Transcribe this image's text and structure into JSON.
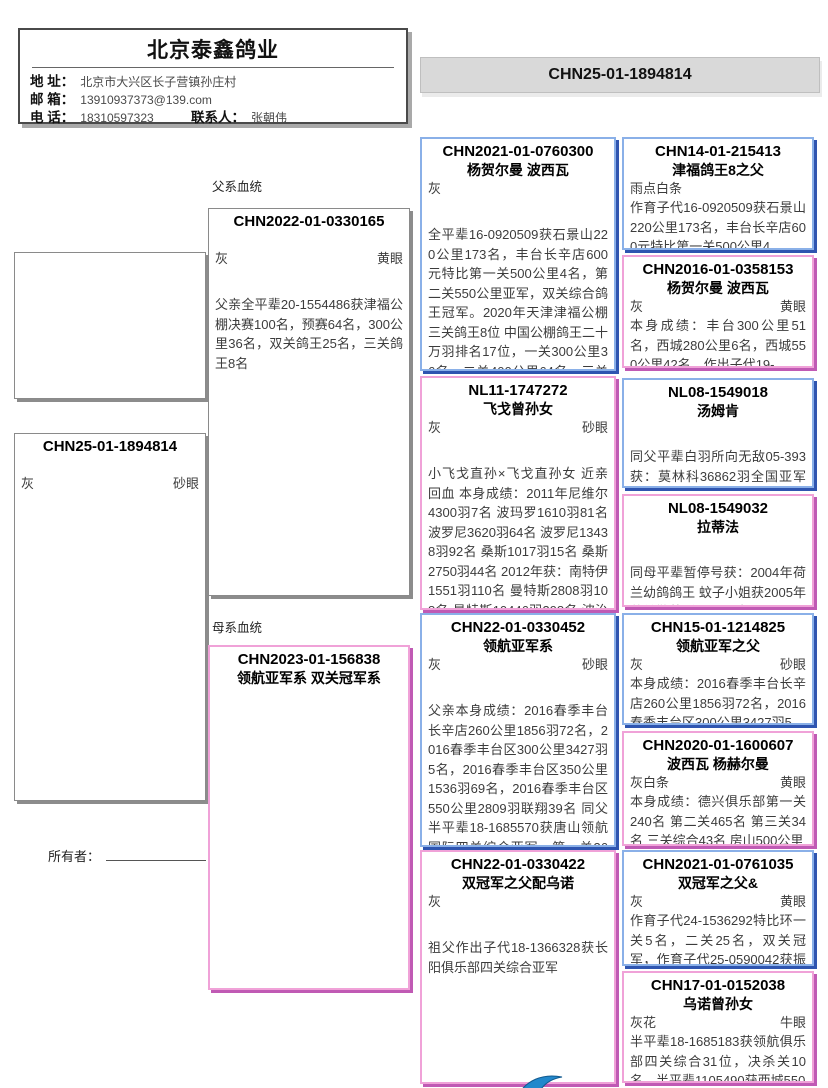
{
  "colors": {
    "cock-border": "#8ab0e8",
    "cock-shadow": "#2f55b0",
    "hen-border": "#f0a2d8",
    "hen-shadow": "#c05ab4",
    "bar-bg": "#d9d9d9",
    "logo-blue": "#2288cc"
  },
  "loft": {
    "name": "北京泰鑫鸽业",
    "address_label": "地 址：",
    "address": "北京市大兴区长子营镇孙庄村",
    "email_label": "邮 箱：",
    "email": "13910937373@139.com",
    "phone_label": "电 话：",
    "phone": "18310597323",
    "contact_label": "联系人：",
    "contact": "张朝伟"
  },
  "header": {
    "ring": "CHN25-01-1894814"
  },
  "labels": {
    "paternal": "父系血统",
    "maternal": "母系血统",
    "owner": "所有者："
  },
  "subject": {
    "ring": "CHN25-01-1894814",
    "color": "灰",
    "eye": "砂眼"
  },
  "gen2": [
    {
      "ring": "CHN2022-01-0330165",
      "name": "",
      "color": "灰",
      "eye": "黄眼",
      "desc": "父亲全平辈20-1554486获津福公棚决赛100名，预赛64名，300公里36名，双关鸽王25名，三关鸽王8名"
    },
    {
      "ring": "CHN2023-01-156838",
      "name": "领航亚军系 双关冠军系",
      "color": "",
      "eye": "",
      "desc": ""
    }
  ],
  "gen3": [
    {
      "ring": "CHN2021-01-0760300",
      "name": "杨贺尔曼 波西瓦",
      "color": "灰",
      "eye": "",
      "desc": "全平辈16-0920509获石景山220公里173名，丰台长辛店600元特比第一关500公里4名，第二关550公里亚军，双关综合鸽王冠军。2020年天津津福公棚三关鸽王8位 中国公棚鸽王二十万羽排名17位，一关300公里36名，二关400公里64名，三关500公"
    },
    {
      "ring": "NL11-1747272",
      "name": "飞戈曾孙女",
      "color": "灰",
      "eye": "砂眼",
      "desc": "小飞戈直孙×飞戈直孙女 近亲回血 本身成绩：2011年尼维尔4300羽7名 波玛罗1610羽81名 波罗尼3620羽64名 波罗尼13438羽92名 桑斯1017羽15名 桑斯2750羽44名 2012年获：南特伊1551羽110名 曼特斯2808羽108名 曼特斯10446羽398名 波治2078羽473名 查特"
    },
    {
      "ring": "CHN22-01-0330452",
      "name": "领航亚军系",
      "color": "灰",
      "eye": "砂眼",
      "desc": "父亲本身成绩：2016春季丰台长辛店260公里1856羽72名，2016春季丰台区300公里3427羽5名，2016春季丰台区350公里1536羽69名，2016春季丰台区550公里2809羽联翔39名 同父半平辈18-1685570获唐山领航国际四关综合亚军，第一关36名、第二关18名、第三关32"
    },
    {
      "ring": "CHN22-01-0330422",
      "name": "双冠军之父配乌诺",
      "color": "灰",
      "eye": "",
      "desc": "祖父作出子代18-1366328获长阳俱乐部四关综合亚军"
    }
  ],
  "gen4": [
    {
      "ring": "CHN14-01-215413",
      "name": "津福鸽王8之父",
      "color": "雨点白条",
      "eye": "",
      "desc": "作育子代16-0920509获石景山220公里173名，丰台长辛店600元特比第一关500公里4"
    },
    {
      "ring": "CHN2016-01-0358153",
      "name": "杨贺尔曼 波西瓦",
      "color": "灰",
      "eye": "黄眼",
      "desc": "本身成绩：丰台300公里51名，西城280公里6名，西城550公里42名，作出子代19-"
    },
    {
      "ring": "NL08-1549018",
      "name": "汤姆肯",
      "color": "",
      "eye": "",
      "desc": "同父平辈白羽所向无敌05-393获：莫林科36862羽全国亚军 香提利22571羽7名 平辈娜拉"
    },
    {
      "ring": "NL08-1549032",
      "name": "拉蒂法",
      "color": "",
      "eye": "",
      "desc": "同母平辈暂停号获：2004年荷兰幼鸽鸽王 蚊子小姐获2005年荷兰勒芒斯12万羽全国亚军"
    },
    {
      "ring": "CHN15-01-1214825",
      "name": "领航亚军之父",
      "color": "灰",
      "eye": "砂眼",
      "desc": "本身成绩：2016春季丰台长辛店260公里1856羽72名，2016春季丰台区300公里3427羽5"
    },
    {
      "ring": "CHN2020-01-1600607",
      "name": "波西瓦 杨赫尔曼",
      "color": "灰白条",
      "eye": "黄眼",
      "desc": "本身成绩：德兴俱乐部第一关240名 第二关465名 第三关34名 三关综合43名 房山500公里"
    },
    {
      "ring": "CHN2021-01-0761035",
      "name": "双冠军之父&",
      "color": "灰",
      "eye": "黄眼",
      "desc": "作育子代24-1536292特比环一关5名，二关25名，双关冠军，作育子代25-0590042获振翔第"
    },
    {
      "ring": "CHN17-01-0152038",
      "name": "乌诺曾孙女",
      "color": "灰花",
      "eye": "牛眼",
      "desc": "半平辈18-1685183获领航俱乐部四关综合31位，决杀关10名，半平辈1105490获西城550"
    }
  ]
}
